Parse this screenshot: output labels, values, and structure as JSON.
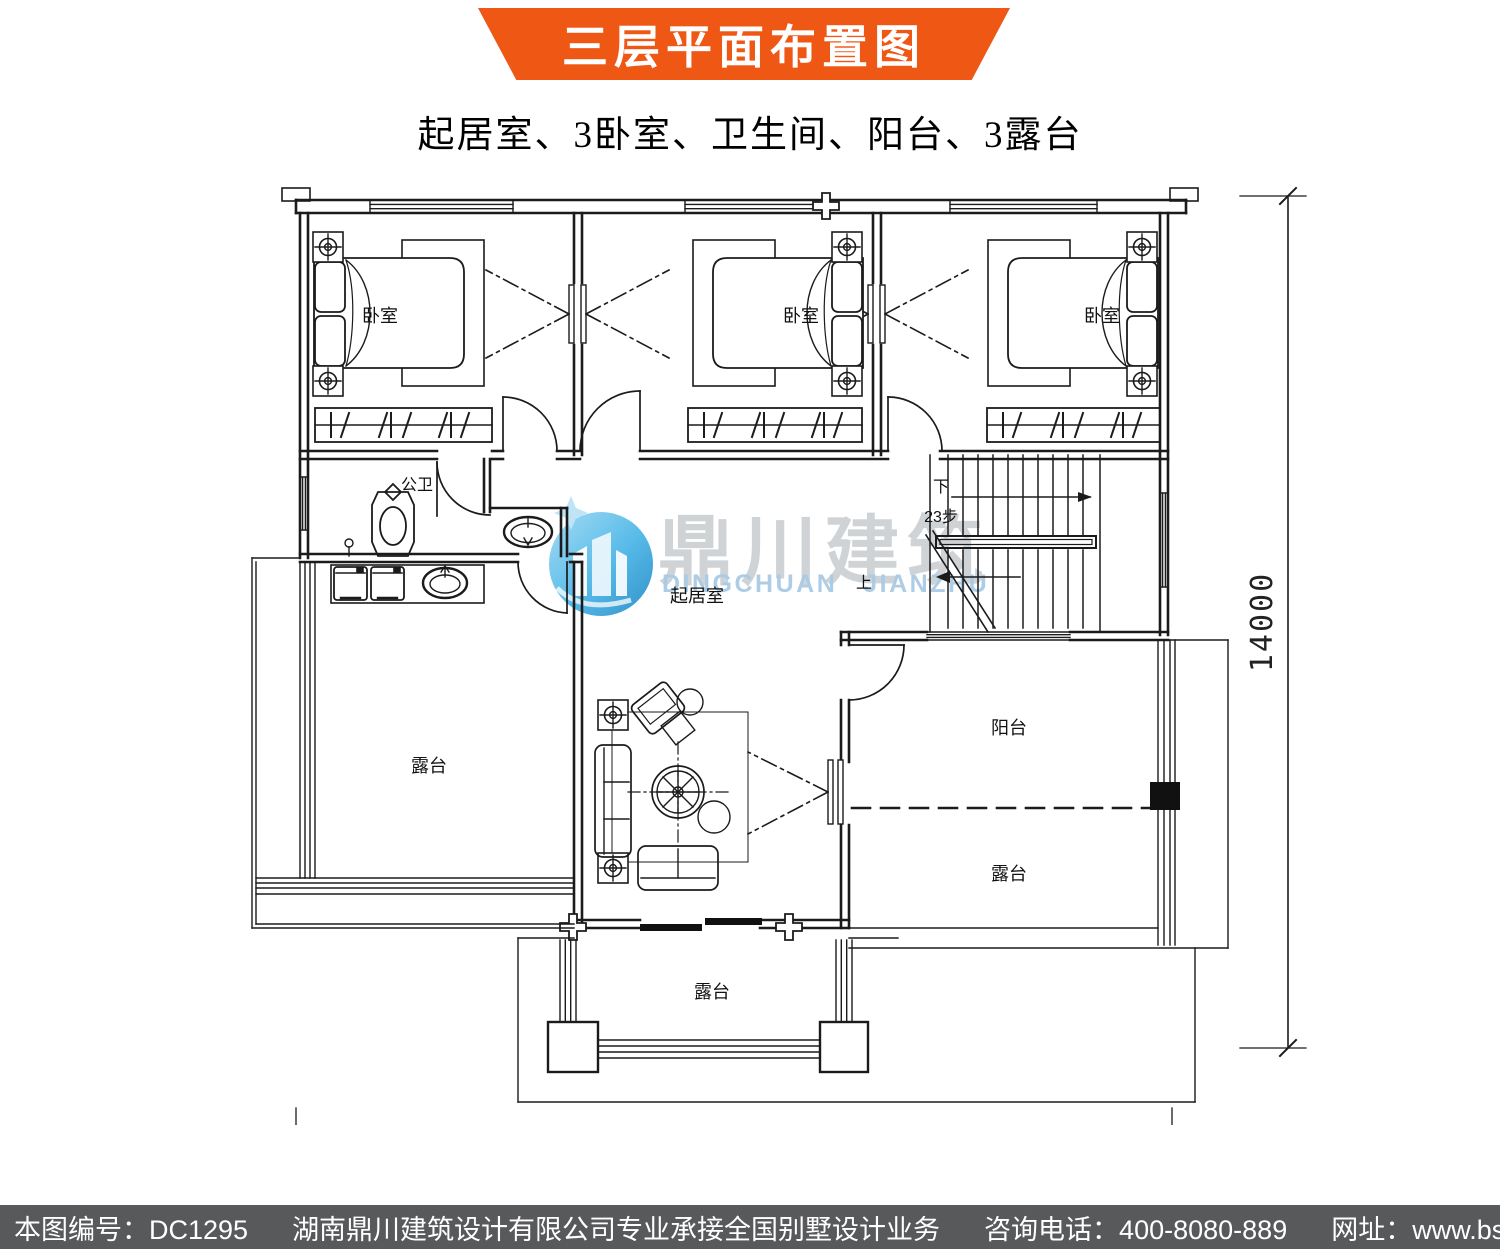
{
  "banner": {
    "title": "三层平面布置图",
    "bg": "#ef5715"
  },
  "subtitle": {
    "text": "起居室、3卧室、卫生间、阳台、3露台"
  },
  "watermark": {
    "cn": "鼎川建筑",
    "en_word1": "DINGCHUAN",
    "en_word2": "JIANZHU",
    "logo_blue": "#47b4e6"
  },
  "plan": {
    "rooms": {
      "bedroom": "卧室",
      "bathroom": "公卫",
      "living_room": "起居室",
      "balcony": "阳台",
      "terrace": "露台"
    },
    "stairs": {
      "down_label": "下",
      "steps_label": "23步",
      "up_label": "上"
    },
    "dimensions": {
      "width_mm": "14500",
      "height_mm": "14000"
    },
    "line_color": "#1b1b1b"
  },
  "footer": {
    "bg": "#58595b",
    "drawing_no": "本图编号：DC1295",
    "company": "湖南鼎川建筑设计有限公司专业承接全国别墅设计业务",
    "phone": "咨询电话：400-8080-889",
    "website": "网址：www.bstzcs.com"
  }
}
